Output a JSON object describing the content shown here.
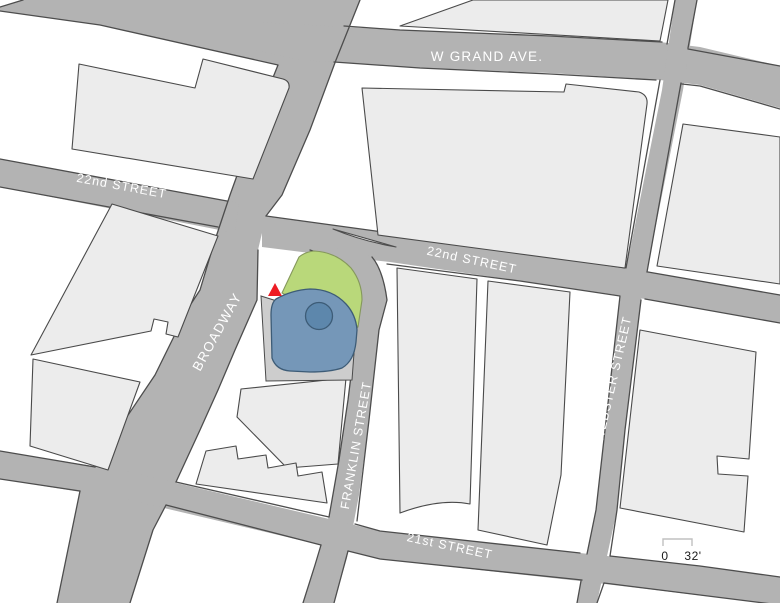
{
  "map": {
    "type": "site-location-plan",
    "streets": {
      "w_grand": "W GRAND AVE.",
      "second_22nd_left": "22nd STREET",
      "second_22nd_right": "22nd STREET",
      "broadway": "BROADWAY",
      "franklin": "FRANKLIN STREET",
      "webster": "WEBSTER STREET",
      "twenty_first": "21st STREET"
    },
    "site": {
      "open_space": "green-open-space-area",
      "building_footprint": "blue-building-footprint",
      "round_feature": "circular-feature",
      "marker": "red-triangle-site-marker"
    },
    "scale_bar": {
      "start_label": "0",
      "end_label": "32'"
    }
  },
  "colors": {
    "background": "#ffffff",
    "street": "#b3b3b3",
    "street_edge": "#4d4d4d",
    "building": "#ececec",
    "building_edge": "#4a4a4a",
    "parcel": "#cdcdcd",
    "parcel_edge": "#4a4a4a",
    "green": "#b9d87a",
    "green_edge": "#85985c",
    "blue": "#7597b8",
    "blue_edge": "#3d5c77",
    "circle_fill": "#5d87ac",
    "red": "#ed1c24",
    "label": "#ffffff",
    "scale_text": "#1a1a1a",
    "scale_bracket": "#c0c0c0"
  }
}
